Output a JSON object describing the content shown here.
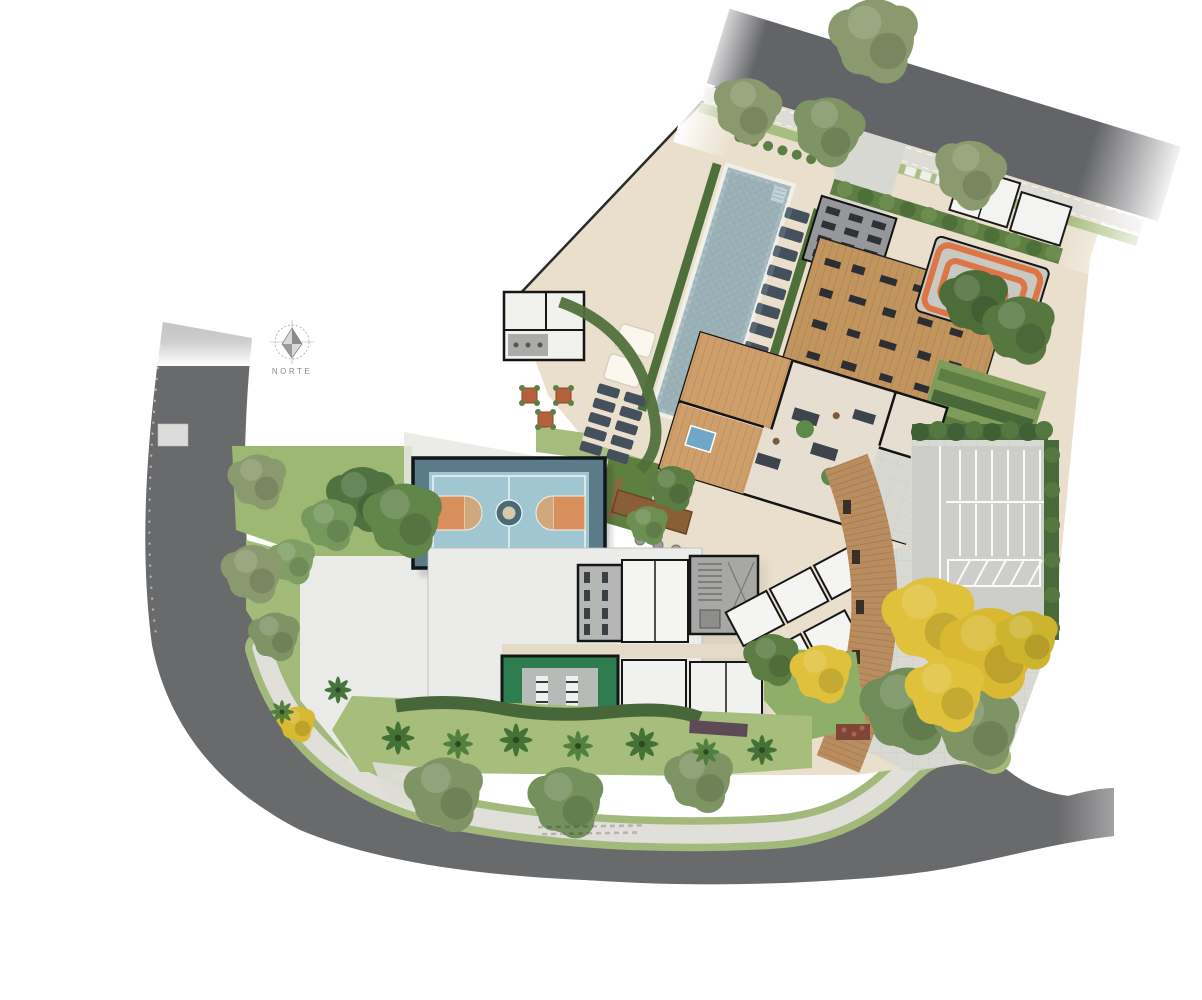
{
  "compass": {
    "label": "NORTE"
  },
  "palette": {
    "background": "#ffffff",
    "road": "#696a6c",
    "road_top": "#636467",
    "sidewalk": "#e0dfda",
    "verge": "#a3b97c",
    "lawn": "#a6bd7c",
    "lawn_dark": "#5d7f3f",
    "park_lawn": "#9cb873",
    "hedge": "#47673b",
    "hedge_purple": "#5a4f62",
    "platform": "#e9dfcc",
    "plaza": "#eaeae8",
    "pool_water": "#9fb4ba",
    "deck_wood": "#c2955f",
    "boardwalk": "#b98d5f",
    "wood_floor": "#cf9f6b",
    "indoor_floor": "#e7ded2",
    "court_frame": "#5b7b89",
    "court_floor": "#a0c6d1",
    "court_key": "#d98f5c",
    "court_lines": "#f2f7f7",
    "playground_base": "#c9c9c4",
    "playground_orange": "#dd7544",
    "paver": "#d9d9d3",
    "parking": "#cdcdc9",
    "parking_lines": "#fafaf8",
    "roof": "#ebebe9",
    "room": "#f4f4f2",
    "wall": "#161616",
    "gym_green": "#2e7d4f",
    "gym_floor": "#b7bbb7",
    "stair": "#a7a7a5",
    "pergola": "#96979a",
    "furniture": "#2e3135",
    "lounger": "#44505c",
    "terracotta": "#b4613b",
    "spa": "#6fa7c7",
    "bed_red": "#7e4637",
    "tree_olive": "#8a9a6e",
    "tree_green": "#62854a",
    "tree_dark": "#4f7340",
    "tree_yellow": "#e0c13b",
    "palm": "#3f6d33",
    "compass_gray": "#8a8a8a"
  }
}
